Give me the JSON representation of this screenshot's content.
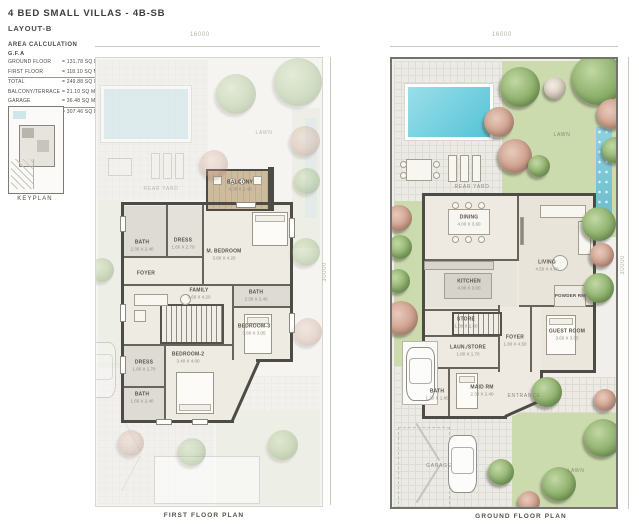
{
  "header": {
    "title": "4 BED SMALL VILLAS - 4B-SB",
    "subtitle": "LAYOUT-B"
  },
  "area_calculation": {
    "heading": "AREA CALCULATION",
    "gfa_label": "G.F.A",
    "rows": [
      {
        "label": "GROUND FLOOR",
        "value": "= 131.78 SQ M"
      },
      {
        "label": "FIRST FLOOR",
        "value": "= 118.10 SQ M"
      },
      {
        "label": "TOTAL",
        "value": "= 249.88 SQ M"
      },
      {
        "label": "BALCONY/TERRACE",
        "value": "= 21.10 SQ M"
      },
      {
        "label": "GARAGE",
        "value": "= 36.48 SQ M"
      },
      {
        "label": "TOTAL AREA",
        "value": "= 307.46 SQ M"
      }
    ]
  },
  "keyplan": {
    "caption": "KEYPLAN"
  },
  "first_floor": {
    "caption": "FIRST FLOOR PLAN",
    "dim_width": "16000",
    "dim_height": "30000",
    "outdoor": {
      "rear_yard": "REAR YARD",
      "lawn": "LAWN"
    },
    "rooms": [
      {
        "name": "BALCONY",
        "dims": "4.35 X 2.40"
      },
      {
        "name": "BATH",
        "dims": "2.30 X 2.40"
      },
      {
        "name": "DRESS",
        "dims": "1.60 X 2.70"
      },
      {
        "name": "M. BEDROOM",
        "dims": "3.80 X 4.20"
      },
      {
        "name": "FOYER",
        "dims": ""
      },
      {
        "name": "FAMILY",
        "dims": "3.60 X 4.20"
      },
      {
        "name": "BATH",
        "dims": "2.30 X 2.40"
      },
      {
        "name": "BEDROOM-3",
        "dims": "3.60 X 3.05"
      },
      {
        "name": "BEDROOM-2",
        "dims": "3.40 X 4.00"
      },
      {
        "name": "DRESS",
        "dims": "1.60 X 1.70"
      },
      {
        "name": "BATH",
        "dims": "1.60 X 2.40"
      }
    ]
  },
  "ground_floor": {
    "caption": "GROUND FLOOR PLAN",
    "dim_width": "16000",
    "dim_height": "30000",
    "outdoor": {
      "rear_yard": "REAR YARD",
      "lawn_top": "LAWN",
      "lawn_bottom": "LAWN",
      "entrance": "ENTRANCE",
      "garage": "GARAGE"
    },
    "rooms": [
      {
        "name": "DINING",
        "dims": "4.00 X 3.60"
      },
      {
        "name": "LIVING",
        "dims": "4.50 X 4.90"
      },
      {
        "name": "KITCHEN",
        "dims": "4.00 X 3.00"
      },
      {
        "name": "STORE",
        "dims": "1.80 X 1.60"
      },
      {
        "name": "LAUN./STORE",
        "dims": "1.80 X 1.70"
      },
      {
        "name": "FOYER",
        "dims": "1.80 X 4.50"
      },
      {
        "name": "POWDER RM",
        "dims": "1.20 X 1.80"
      },
      {
        "name": "GUEST ROOM",
        "dims": "3.60 X 3.05"
      },
      {
        "name": "MAID RM",
        "dims": "2.30 X 2.40"
      },
      {
        "name": "BATH",
        "dims": "1.20 X 1.80"
      }
    ]
  },
  "colors": {
    "lawn": "#ccdbae",
    "pool": "#55c3d6",
    "wall": "#4d4b46",
    "deck": "#cdbb9e"
  }
}
